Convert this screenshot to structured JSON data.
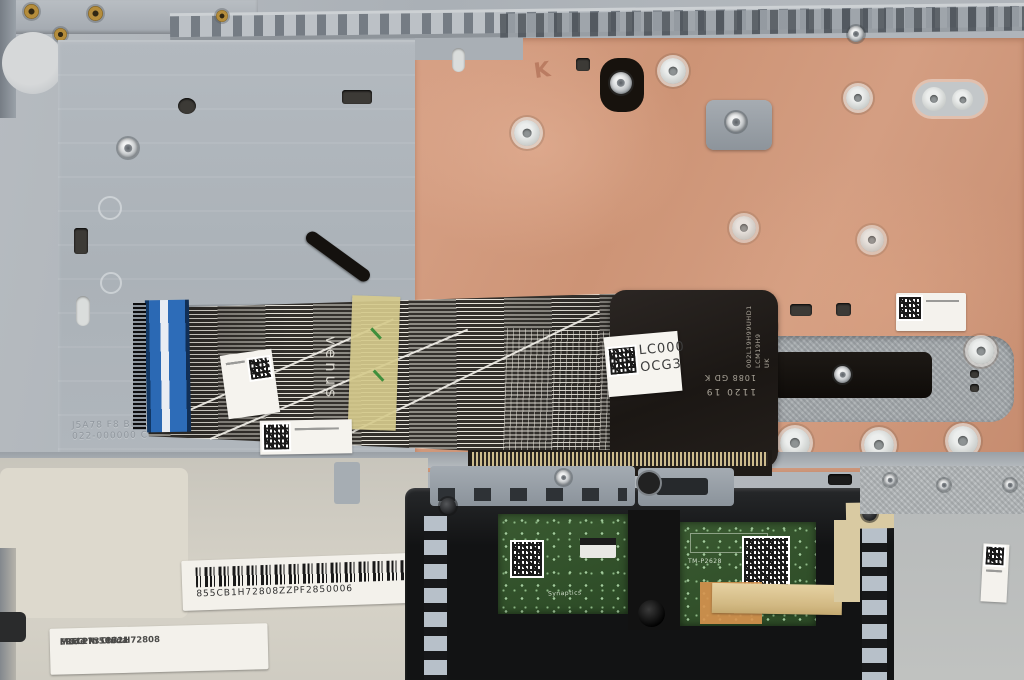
{
  "labels": {
    "fru": {
      "mo": "MO: 17318721",
      "made_in": "Made in China",
      "fru_pn": "FRU PN:5CB1H72808",
      "vendor": "LCFC"
    },
    "barcode": {
      "code": "855CB1H72808ZZPF2850006"
    },
    "membrane": {
      "line1": "LC000",
      "line2": "OCG3"
    },
    "membrane_print": {
      "line1": "1120 19",
      "line2": "1088 GD K",
      "vertical1": "002L19H99UHD1",
      "vertical2": "LCM19H9 UK"
    },
    "flex": {
      "brand": "venus"
    },
    "copper": {
      "mark": "K"
    },
    "touchpad": {
      "model": "TM-P2628",
      "vendor": "Synaptics"
    },
    "emboss": {
      "line1": "J5A78 F8 BRACKET",
      "line2": "022-000000 C"
    }
  }
}
